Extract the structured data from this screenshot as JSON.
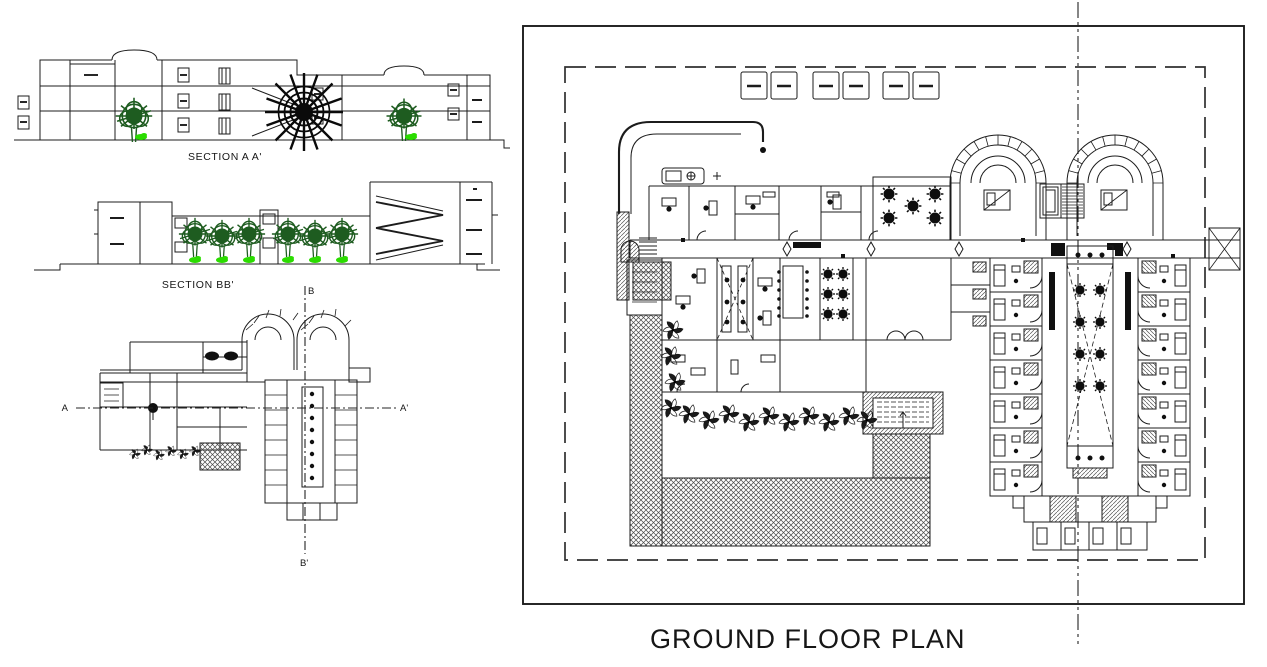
{
  "colors": {
    "line": "#1c1c1c",
    "tree_canopy": "#1e5c20",
    "shrub_green": "#2bdc00",
    "black_tree": "#0a0a0a",
    "hatch_gray": "#4a4a4a",
    "paper": "#ffffff"
  },
  "sections": {
    "aa_label": "SECTION A A'",
    "bb_label": "SECTION BB'"
  },
  "key_plan": {
    "a": "A",
    "a_prime": "A'",
    "b": "B",
    "b_prime": "B'"
  },
  "sheet": {
    "title": "GROUND FLOOR PLAN",
    "parking_stalls": 6,
    "horseshoe_wings": 2
  }
}
